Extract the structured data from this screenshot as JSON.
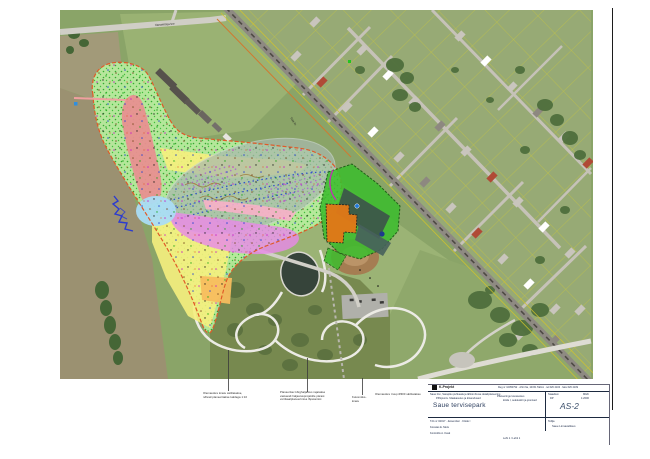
{
  "map": {
    "road_label": "Vanamõisa tee",
    "railside_label": "Tule tn"
  },
  "colors": {
    "site_boundary": "#e05a28",
    "overlay_green": "#b9f0a1",
    "overlay_red": "#e89090",
    "overlay_yellow": "#f5f07e",
    "overlay_orange": "#f7bd5e",
    "water_gray": "#a9b9ae",
    "overlay_magenta": "#e88ae8",
    "overlay_pink": "#f8b0c8",
    "overlay_lightblue": "#aadcf4",
    "dev_green": "#3dbd2e",
    "dev_orange": "#e07818",
    "cadastre_yellow": "#cfca35"
  },
  "notes": {
    "n1_line1": "Olemasolev kraav säilitatakse,",
    "n1_line2": "nõlvad planeeritakse kaldega 1:10",
    "n2_line1": "Planeeritav kõrghaljastus rajatakse",
    "n2_line2": "vastavalt haljastusprojektile pärast",
    "n2_line3": "vertikaalplaneerimise lõpetamist",
    "n3_line1": "Kuivendus-",
    "n3_line2": "kraav",
    "n3_right": "Olemasolev truup Ø300 säilitatakse"
  },
  "titleblock": {
    "logo_text": "K-Projekt",
    "header_right": "Reg nr 10050792 · Ahtri 6a, 10151 Tallinn · tel 626 4100 · faks 626 4109",
    "project_line1": "Saue linn, Sarapiku puhkeala ja lähiümbruse detailplaneering",
    "project_line2": "Põhijoonis. Maakasutus ja kitsendused",
    "mid_line1": "Planeeringu koosseisus",
    "mid_line2": "köide I, seletuskiri ja joonised",
    "drawing_title": "Saue tervisepark",
    "stage_label": "Staadium",
    "stage_value": "DP",
    "scale_label": "Mõõt",
    "scale_value": "1:2000",
    "sheet_number": "AS-2",
    "work_line": "Töö nr 02017 · detsember · Köide I",
    "author_line1": "Koostas  E. Mets",
    "author_line2": "Kontrollis  A. Kask",
    "bottom_center": "Leht 1 / Lehti 1",
    "client_label": "Tellija",
    "client_value": "Saue Linnavalitsus"
  }
}
